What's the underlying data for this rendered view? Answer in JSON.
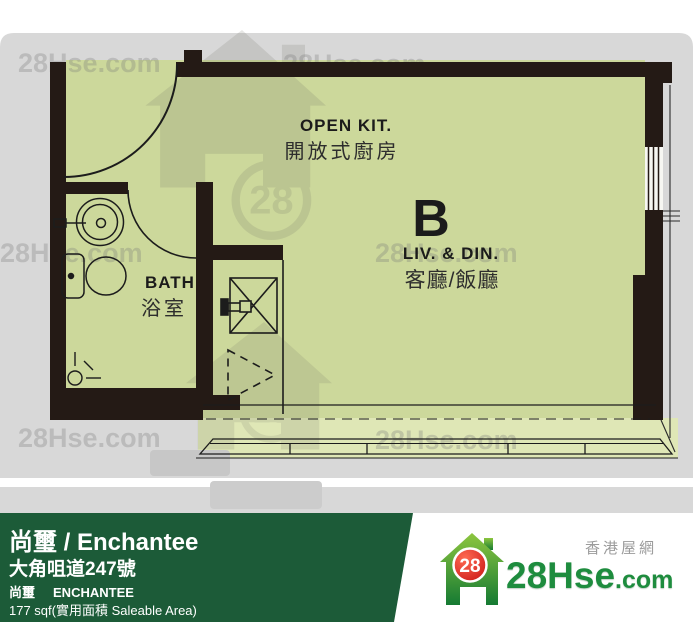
{
  "floorplan": {
    "unit_label": "B",
    "kitchen": {
      "en": "OPEN KIT.",
      "zh": "開放式廚房"
    },
    "living": {
      "en": "LIV. & DIN.",
      "zh": "客廳/飯廳"
    },
    "bath": {
      "en": "BATH",
      "zh": "浴室"
    },
    "fixtures": [
      "entrance-door",
      "bath-door",
      "sink",
      "toilet",
      "floor-drain",
      "shower-box",
      "louver-panel",
      "bay-window",
      "right-window"
    ]
  },
  "watermark": {
    "text": "28Hse.com",
    "badge": "28"
  },
  "footer": {
    "title": "尚璽 / Enchantee",
    "address": "大角咀道247號",
    "name_zh": "尚璽",
    "name_en": "ENCHANTEE",
    "area": "177 sqf(實用面積 Saleable Area)",
    "brand": {
      "badge": "28",
      "site": "28Hse",
      "tld": ".com",
      "tagline": "香港屋網"
    }
  },
  "colors": {
    "wall": "#241a15",
    "room_fill": "#ccd89b",
    "band_fill": "#dfe7b6",
    "backdrop": "#d8d8d8",
    "bar_green": "#1c5b38",
    "brand_green": "#1e8c3e",
    "brand_red": "#d81e1e"
  }
}
